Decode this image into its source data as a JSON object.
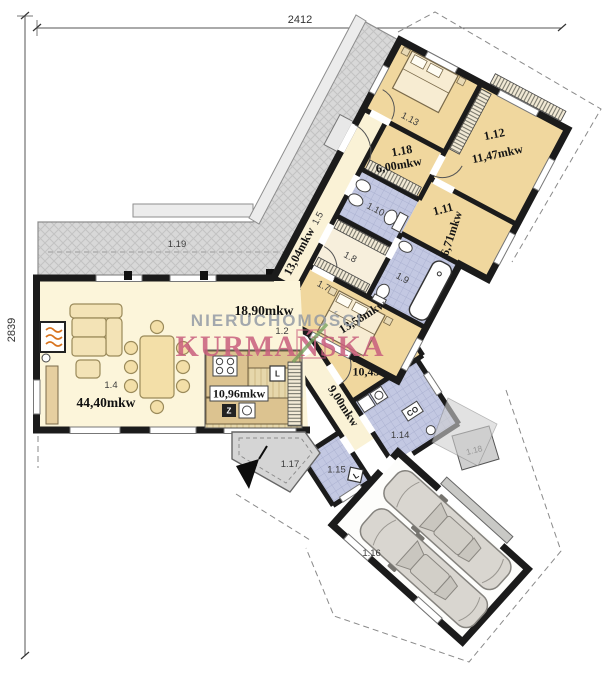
{
  "dimensions": {
    "top": "2412",
    "left": "2839"
  },
  "watermark": {
    "line1": "NIERUCHOMOŚCI",
    "line2": "KURMAŃSKA"
  },
  "rooms": {
    "r1_2": {
      "num": "1.2",
      "area": "18,90mkw"
    },
    "r1_4": {
      "num": "1.4",
      "area": "44,40mkw"
    },
    "kitchen": {
      "area": "10,96mkw"
    },
    "r1_5": {
      "num": "1.5",
      "area": "13,04mkw"
    },
    "r1_6": {
      "num": "1.6",
      "area": "10,45mkw"
    },
    "r1_7": {
      "num": "1.7",
      "area": "13,58mkw"
    },
    "r1_8": {
      "num": "1.8"
    },
    "r1_9": {
      "num": "1.9"
    },
    "r1_10": {
      "num": "1.10"
    },
    "r1_11": {
      "num": "1.11",
      "area": "6,71mkw"
    },
    "r1_12": {
      "num": "1.12",
      "area": "11,47mkw"
    },
    "r1_13": {
      "num": "1.13"
    },
    "r1_14": {
      "num": "1.14"
    },
    "r1_15": {
      "num": "1.15"
    },
    "r1_16": {
      "num": "1.16"
    },
    "r1_17": {
      "num": "1.17"
    },
    "r1_18": {
      "num": "1.18",
      "area": "6,00mkw"
    },
    "r1_18_ext": {
      "num": "1.18"
    },
    "r1_19": {
      "num": "1.19"
    },
    "hall9": {
      "area": "9,00mkw"
    }
  },
  "markers": {
    "fridge": "L",
    "pantry_l": "L",
    "sink_z": "Z",
    "boiler_co": "CO"
  },
  "colors": {
    "room_tan": "#f0d79e",
    "room_cream": "#faf2d6",
    "bath_blue": "#c3c8e2",
    "terrace_gray": "#d8d8d8",
    "wall": "#1b1b1b",
    "watermark_gray": "#8e96a2",
    "watermark_pink": "#c95f7e"
  }
}
